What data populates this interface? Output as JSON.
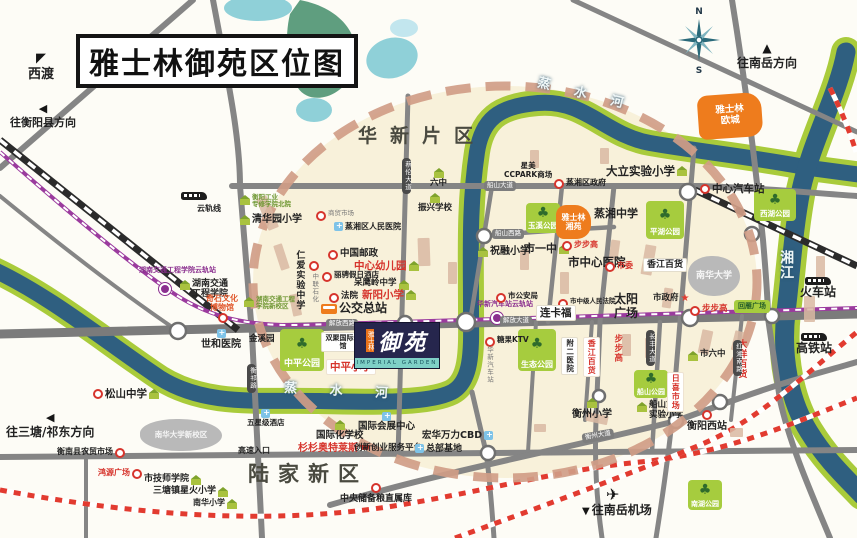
{
  "meta": {
    "title": "雅士林御苑区位图"
  },
  "compass": {
    "n": "N",
    "s": "S"
  },
  "project": {
    "brand": "雅士林",
    "name": "御苑",
    "english": "IMPERIAL GARDEN"
  },
  "colors": {
    "river": "#2f5f80",
    "river_bank": "#a9cb3b",
    "road": "#858585",
    "circle_dash": "#d09d87",
    "orange_block": "#ee7c1d",
    "park_green": "#a6cc3e",
    "rail_red": "#e23b30",
    "monorail_purple": "#9b3b9e"
  },
  "pois": [
    {
      "id": "dir-xidu",
      "cls": "dark col",
      "icon": "arrow-nw",
      "label": "西渡",
      "x": 28,
      "y": 52,
      "fs": 13
    },
    {
      "id": "dir-hengyang-county",
      "cls": "dark col",
      "icon": "arrow-l",
      "label": "往衡阳县方向",
      "x": 10,
      "y": 103,
      "fs": 11
    },
    {
      "id": "dir-nanyue",
      "cls": "dark col",
      "icon": "arrow-up",
      "label": "往南岳方向",
      "x": 737,
      "y": 42,
      "fs": 12
    },
    {
      "id": "dir-santang",
      "cls": "dark col",
      "icon": "arrow-l",
      "label": "往三塘/祁东方向",
      "x": 6,
      "y": 411,
      "fs": 12
    },
    {
      "id": "airport-plane",
      "cls": "dark",
      "icon": "plane",
      "label": "",
      "x": 606,
      "y": 487
    },
    {
      "id": "dir-airport",
      "cls": "dark",
      "icon": "arrow-dn",
      "label": "往南岳机场",
      "x": 582,
      "y": 504,
      "fs": 12
    },
    {
      "id": "river-zhengshui-top",
      "cls": "river",
      "label": "蒸 水 河",
      "x": 536,
      "y": 88,
      "fs": 13,
      "rot": 14,
      "ls": 10
    },
    {
      "id": "river-zhengshui-bottom",
      "cls": "river",
      "label": "蒸 水 河",
      "x": 284,
      "y": 385,
      "fs": 13,
      "rot": 3,
      "ls": 14
    },
    {
      "id": "river-xiangjiang",
      "cls": "river",
      "label": "湘江",
      "x": 778,
      "y": 250,
      "fs": 14,
      "vert": true,
      "ls": 8
    },
    {
      "id": "district-huaxin",
      "cls": "district",
      "label": "华新片区",
      "x": 358,
      "y": 126,
      "fs": 19,
      "ls": 13
    },
    {
      "id": "district-lujia",
      "cls": "district",
      "label": "陆家新区",
      "x": 248,
      "y": 462,
      "fs": 21,
      "ls": 9
    },
    {
      "id": "plate-jiefang-west-rd",
      "cls": "plate-h",
      "label": "解放西路",
      "x": 326,
      "y": 319,
      "fs": 6.5
    },
    {
      "id": "plate-jiefang-ave",
      "cls": "plate-h",
      "label": "解放大道",
      "x": 500,
      "y": 316,
      "fs": 6.5
    },
    {
      "id": "plate-chuanshan-ave",
      "cls": "plate-h",
      "label": "船山大道",
      "x": 484,
      "y": 181,
      "fs": 6.5
    },
    {
      "id": "plate-chuanshan-west-rd",
      "cls": "plate-h",
      "label": "船山西路",
      "x": 492,
      "y": 229,
      "fs": 6.5
    },
    {
      "id": "plate-hengzhou-ave",
      "cls": "plate-h",
      "label": "衡州大道",
      "x": 582,
      "y": 431,
      "fs": 6.5,
      "rot": -10
    },
    {
      "id": "plate-cailun-ave",
      "cls": "plate-v",
      "label": "蔡伦大道",
      "x": 402,
      "y": 158,
      "fs": 6.5
    },
    {
      "id": "plate-hengqi-rd",
      "cls": "plate-v",
      "label": "衡祁路",
      "x": 247,
      "y": 364,
      "fs": 6.5
    },
    {
      "id": "plate-changfeng-ave",
      "cls": "plate-v",
      "label": "长丰大道",
      "x": 646,
      "y": 330,
      "fs": 6.5
    },
    {
      "id": "plate-hongxiang-south-rd",
      "cls": "plate-v",
      "label": "红湘南路",
      "x": 733,
      "y": 340,
      "fs": 6.5
    },
    {
      "id": "monorail-train",
      "cls": "dark",
      "icon": "train",
      "label": "",
      "x": 181,
      "y": 192
    },
    {
      "id": "monorail-line",
      "cls": "dark",
      "label": "云轨线",
      "x": 197,
      "y": 204,
      "fs": 8
    },
    {
      "id": "station-jiaotong-dot",
      "cls": "dark",
      "icon": "station",
      "label": "",
      "x": 159,
      "y": 283
    },
    {
      "id": "station-jiaotong",
      "cls": "purple",
      "label": "湖南交通工程学院云轨站",
      "x": 139,
      "y": 266,
      "fs": 7
    },
    {
      "id": "station-huaxin-dot",
      "cls": "dark",
      "icon": "station",
      "label": "",
      "x": 491,
      "y": 312
    },
    {
      "id": "station-huaxin",
      "cls": "purple",
      "label": "华新汽车站云轨站",
      "x": 477,
      "y": 300,
      "fs": 7
    },
    {
      "id": "poi-hengyang-tech-college",
      "cls": "green",
      "icon": "school",
      "label": "衡阳工业\n专修学院北院",
      "x": 240,
      "y": 194,
      "fs": 6.5
    },
    {
      "id": "poi-qinghuayuan-primary",
      "cls": "dark",
      "icon": "school",
      "label": "清华园小学",
      "x": 240,
      "y": 214,
      "fs": 10
    },
    {
      "id": "poi-shangmao-market",
      "cls": "gray",
      "icon": "dot",
      "label": "商贸市场",
      "x": 316,
      "y": 210,
      "fs": 6.5
    },
    {
      "id": "poi-zhengxiang-people-hospital",
      "cls": "dark",
      "icon": "hosp",
      "label": "蒸湘区人民医院",
      "x": 334,
      "y": 222,
      "fs": 8
    },
    {
      "id": "poi-china-post",
      "cls": "dark",
      "icon": "dot",
      "label": "中国邮政",
      "x": 328,
      "y": 249,
      "fs": 9.5
    },
    {
      "id": "poi-central-kindergarten",
      "cls": "red",
      "icon2": "school",
      "label": "中心幼儿园",
      "x": 354,
      "y": 260,
      "fs": 10.5
    },
    {
      "id": "poi-licheng-hotel",
      "cls": "dark",
      "icon": "dot",
      "label": "丽骋假日酒店",
      "x": 322,
      "y": 271,
      "fs": 7.5
    },
    {
      "id": "poi-daiyingling-middle",
      "cls": "dark",
      "icon2": "school",
      "label": "呆鹰岭中学",
      "x": 354,
      "y": 279,
      "fs": 8.5
    },
    {
      "id": "poi-court",
      "cls": "dark",
      "icon": "dot",
      "label": "法院",
      "x": 329,
      "y": 292,
      "fs": 8.5
    },
    {
      "id": "poi-xinyang-primary",
      "cls": "red",
      "icon2": "school",
      "label": "新阳小学",
      "x": 362,
      "y": 289,
      "fs": 10.5
    },
    {
      "id": "poi-bus-terminal",
      "cls": "dark",
      "icon": "bus",
      "label": "公交总站",
      "x": 321,
      "y": 302,
      "fs": 12
    },
    {
      "id": "poi-renai-middle",
      "cls": "dark",
      "label": "仁爱实验中学",
      "x": 294,
      "y": 250,
      "fs": 9,
      "vert": true
    },
    {
      "id": "poi-zhonglian-petrol",
      "cls": "gray",
      "icon": "dot",
      "label": "中联石化",
      "x": 309,
      "y": 260,
      "fs": 6.5,
      "vert": true
    },
    {
      "id": "poi-jiaotong-new-campus",
      "cls": "green",
      "icon": "school",
      "label": "湖南交通工程\n学院新校区",
      "x": 244,
      "y": 296,
      "fs": 6.5
    },
    {
      "id": "poi-jiaotong-college",
      "cls": "dark",
      "icon": "school",
      "label": "湖南交通\n工程学院",
      "x": 180,
      "y": 279,
      "fs": 9
    },
    {
      "id": "poi-qishi-museum",
      "cls": "orangered tc",
      "label": "奇石文化\n博物馆",
      "x": 206,
      "y": 294,
      "fs": 8
    },
    {
      "id": "poi-qishi-dot",
      "cls": "dark",
      "icon": "dot",
      "label": "",
      "x": 218,
      "y": 312
    },
    {
      "id": "poi-shihe-hospital",
      "cls": "dark col",
      "icon": "hosp",
      "label": "世和医院",
      "x": 201,
      "y": 329,
      "fs": 10
    },
    {
      "id": "poi-jinxiyuan",
      "cls": "dark",
      "label": "金溪园",
      "x": 249,
      "y": 335,
      "fs": 8.5
    },
    {
      "id": "park-zhongping",
      "cls": "park",
      "label": "中平公园",
      "x": 280,
      "y": 329,
      "w": 44,
      "h": 42,
      "fs": 9
    },
    {
      "id": "poi-shuangju-mansion",
      "cls": "white-box tc",
      "label": "双聚国际公馆",
      "x": 321,
      "y": 332,
      "fs": 7,
      "w": 36
    },
    {
      "id": "poi-zhongping-primary",
      "cls": "box-red",
      "label": "中平小学",
      "x": 326,
      "y": 359,
      "fs": 10.5
    },
    {
      "id": "poi-liuzhong",
      "cls": "dark col",
      "icon": "school",
      "label": "六中",
      "x": 430,
      "y": 167,
      "fs": 8.5
    },
    {
      "id": "poi-zhenxing-school",
      "cls": "dark col",
      "icon": "school",
      "label": "振兴学校",
      "x": 418,
      "y": 192,
      "fs": 8.5
    },
    {
      "id": "poi-ccpark",
      "cls": "dark tc",
      "label": "星美\nCCPARK商场",
      "x": 504,
      "y": 162,
      "fs": 7.5
    },
    {
      "id": "poi-zhengxiang-gov",
      "cls": "dark",
      "icon": "dot",
      "label": "蒸湘区政府",
      "x": 554,
      "y": 178,
      "fs": 8
    },
    {
      "id": "poi-dali-primary",
      "cls": "dark",
      "icon2": "school",
      "label": "大立实验小学",
      "x": 606,
      "y": 165,
      "fs": 11.5
    },
    {
      "id": "poi-central-bus-station",
      "cls": "dark",
      "icon": "dot",
      "label": "中心汽车站",
      "x": 700,
      "y": 183,
      "fs": 10.5
    },
    {
      "id": "park-xihu",
      "cls": "park",
      "label": "西湖公园",
      "x": 754,
      "y": 189,
      "w": 42,
      "h": 32,
      "fs": 7.5
    },
    {
      "id": "park-yuxi",
      "cls": "park",
      "label": "玉溪公园",
      "x": 526,
      "y": 203,
      "w": 34,
      "h": 30,
      "fs": 7.5
    },
    {
      "id": "block-yashilin-xiangyuan",
      "cls": "orange",
      "label": "雅士林\n湘苑",
      "x": 556,
      "y": 205,
      "w": 35,
      "h": 34,
      "fs": 8
    },
    {
      "id": "poi-zhengxiang-middle",
      "cls": "dark",
      "label": "蒸湘中学",
      "x": 594,
      "y": 208,
      "fs": 11
    },
    {
      "id": "park-pinghu",
      "cls": "park",
      "label": "平湖公园",
      "x": 646,
      "y": 201,
      "w": 38,
      "h": 38,
      "fs": 7.5
    },
    {
      "id": "block-yashilin-oucheng",
      "cls": "orange",
      "label": "雅士林\n欧城",
      "x": 698,
      "y": 94,
      "w": 64,
      "h": 44,
      "fs": 9.5,
      "rot": -4
    },
    {
      "id": "poi-zhurong-primary",
      "cls": "dark",
      "icon": "school",
      "label": "祝融小学",
      "x": 478,
      "y": 246,
      "fs": 10
    },
    {
      "id": "poi-shiyizhong",
      "cls": "dark",
      "icon2": "school",
      "label": "市一中",
      "x": 524,
      "y": 243,
      "fs": 11
    },
    {
      "id": "poi-bubugao-2",
      "cls": "red",
      "icon": "dot",
      "label": "步步高",
      "x": 562,
      "y": 240,
      "fs": 8
    },
    {
      "id": "poi-city-central-hospital",
      "cls": "dark",
      "label": "市中心医院",
      "x": 568,
      "y": 256,
      "fs": 11.5
    },
    {
      "id": "poi-shiwei",
      "cls": "red",
      "icon": "dot",
      "label": "市委",
      "x": 605,
      "y": 261,
      "fs": 8
    },
    {
      "id": "poi-xiangjiang-dept",
      "cls": "white-box",
      "label": "香江百货",
      "x": 643,
      "y": 258,
      "fs": 9
    },
    {
      "id": "blob-nanhua-univ",
      "cls": "blob-gray",
      "label": "南华大学",
      "x": 688,
      "y": 256,
      "w": 52,
      "h": 40,
      "fs": 9
    },
    {
      "id": "poi-public-security",
      "cls": "dark",
      "icon": "dot",
      "label": "市公安局",
      "x": 496,
      "y": 292,
      "fs": 7.5
    },
    {
      "id": "poi-intermediate-court",
      "cls": "dark",
      "icon": "dot",
      "label": "市中级人民法院",
      "x": 558,
      "y": 298,
      "fs": 6.5
    },
    {
      "id": "poi-lianka",
      "cls": "white-box",
      "label": "连卡福",
      "x": 536,
      "y": 305,
      "fs": 10.5
    },
    {
      "id": "poi-taiyang-square",
      "cls": "dark tc",
      "label": "太阳\n广场",
      "x": 614,
      "y": 293,
      "fs": 12
    },
    {
      "id": "poi-city-gov",
      "cls": "dark",
      "icon2": "star",
      "label": "市政府",
      "x": 653,
      "y": 294,
      "fs": 8.5
    },
    {
      "id": "poi-bubugao-dot",
      "cls": "red",
      "icon": "dot",
      "label": "步步高",
      "x": 690,
      "y": 305,
      "fs": 8.5
    },
    {
      "id": "park-huiyan-square",
      "cls": "park-flat",
      "label": "回雁广场",
      "x": 734,
      "y": 300,
      "w": 36,
      "h": 13,
      "fs": 7
    },
    {
      "id": "poi-tangguo-ktv",
      "cls": "dark",
      "icon": "dot",
      "label": "糖果KTV",
      "x": 485,
      "y": 336,
      "fs": 7.5
    },
    {
      "id": "poi-huaxin-bus-station",
      "cls": "gray",
      "label": "华新汽车站",
      "x": 485,
      "y": 346,
      "fs": 6.5,
      "vert": true
    },
    {
      "id": "park-shengtai",
      "cls": "park",
      "label": "生态公园",
      "x": 518,
      "y": 329,
      "w": 38,
      "h": 42,
      "fs": 8
    },
    {
      "id": "poi-fuer-hospital",
      "cls": "white-box",
      "label": "附二医院",
      "x": 561,
      "y": 337,
      "fs": 7.5,
      "vert": true
    },
    {
      "id": "poi-xiangjiang-dept-v",
      "cls": "box-red",
      "label": "香江百货",
      "x": 583,
      "y": 337,
      "fs": 8,
      "vert": true
    },
    {
      "id": "poi-bubugao-v",
      "cls": "red",
      "label": "步步高",
      "x": 612,
      "y": 334,
      "fs": 8.5,
      "vert": true
    },
    {
      "id": "poi-dayang-dept",
      "cls": "red",
      "label": "大洋百货",
      "x": 736,
      "y": 339,
      "fs": 9,
      "vert": true
    },
    {
      "id": "poi-shiliuzhong",
      "cls": "dark",
      "icon": "school",
      "label": "市六中",
      "x": 688,
      "y": 350,
      "fs": 8.5
    },
    {
      "id": "poi-railway-station",
      "cls": "dark col",
      "icon": "train",
      "label": "火车站",
      "x": 800,
      "y": 277,
      "fs": 12
    },
    {
      "id": "poi-hsr-station",
      "cls": "dark col",
      "icon": "train",
      "label": "高铁站",
      "x": 796,
      "y": 333,
      "fs": 12
    },
    {
      "id": "poi-hengzhou-primary",
      "cls": "dark col",
      "icon": "school",
      "label": "衡州小学",
      "x": 572,
      "y": 397,
      "fs": 10
    },
    {
      "id": "park-chuanshan",
      "cls": "park",
      "label": "船山公园",
      "x": 634,
      "y": 370,
      "w": 34,
      "h": 28,
      "fs": 7
    },
    {
      "id": "poi-chuanshan-2nd-primary",
      "cls": "dark",
      "icon": "school",
      "label": "船山第二\n实验小学",
      "x": 637,
      "y": 401,
      "fs": 8.5
    },
    {
      "id": "poi-rixi-market",
      "cls": "box-red",
      "label": "日喜市场",
      "x": 667,
      "y": 372,
      "fs": 8,
      "vert": true
    },
    {
      "id": "poi-hengyang-west-station",
      "cls": "dark col",
      "icon": "dot",
      "label": "衡阳西站",
      "x": 687,
      "y": 409,
      "fs": 10
    },
    {
      "id": "park-nanhu",
      "cls": "park",
      "label": "南湖公园",
      "x": 688,
      "y": 480,
      "w": 34,
      "h": 30,
      "fs": 7
    },
    {
      "id": "poi-songshan-middle",
      "cls": "dark",
      "icon": "dot",
      "icon2": "school",
      "label": "松山中学",
      "x": 93,
      "y": 388,
      "fs": 10.5
    },
    {
      "id": "blob-nanhua-new-campus",
      "cls": "blob-gray",
      "label": "南华大学新校区",
      "x": 140,
      "y": 419,
      "w": 82,
      "h": 32,
      "fs": 7.5
    },
    {
      "id": "poi-hengnan-market",
      "cls": "dark",
      "icon2": "dot",
      "label": "衡南县农贸市场",
      "x": 57,
      "y": 447,
      "fs": 8
    },
    {
      "id": "poi-hongyuan-square",
      "cls": "red",
      "icon2": "dot",
      "label": "鸿源广场",
      "x": 98,
      "y": 468,
      "fs": 8
    },
    {
      "id": "poi-tech-teachers-college",
      "cls": "dark",
      "icon2": "school",
      "label": "市技师学院",
      "x": 144,
      "y": 474,
      "fs": 9
    },
    {
      "id": "poi-santang-xinghuo-primary",
      "cls": "dark",
      "icon2": "school",
      "label": "三塘镇星火小学",
      "x": 153,
      "y": 486,
      "fs": 9
    },
    {
      "id": "poi-nanhua-primary",
      "cls": "dark",
      "icon2": "school",
      "label": "南华小学",
      "x": 193,
      "y": 498,
      "fs": 8
    },
    {
      "id": "poi-five-star-hotel",
      "cls": "dark col",
      "icon": "hosp",
      "label": "五星级酒店",
      "x": 247,
      "y": 409,
      "fs": 7.5
    },
    {
      "id": "poi-highway-entrance",
      "cls": "dark",
      "label": "高速入口",
      "x": 238,
      "y": 446,
      "fs": 8
    },
    {
      "id": "poi-intl-school",
      "cls": "dark col",
      "icon": "school",
      "label": "国际化学校",
      "x": 316,
      "y": 419,
      "fs": 9.5
    },
    {
      "id": "poi-intl-expo-center",
      "cls": "dark col",
      "icon": "hosp",
      "label": "国际会展中心",
      "x": 358,
      "y": 412,
      "fs": 9.5
    },
    {
      "id": "poi-shanshan-outlets",
      "cls": "red",
      "icon2": "cart",
      "label": "杉杉奥特莱斯",
      "x": 298,
      "y": 443,
      "fs": 10
    },
    {
      "id": "poi-innovation-platform",
      "cls": "dark",
      "label": "创新创业服务平台",
      "x": 354,
      "y": 444,
      "fs": 8.5
    },
    {
      "id": "poi-honghua-cbd",
      "cls": "dark",
      "icon2": "hosp",
      "label": "宏华万力CBD",
      "x": 422,
      "y": 431,
      "fs": 9.5
    },
    {
      "id": "poi-hq-base",
      "cls": "dark",
      "icon": "hosp",
      "label": "总部基地",
      "x": 415,
      "y": 444,
      "fs": 9
    },
    {
      "id": "poi-grain-depot",
      "cls": "dark col",
      "icon": "dot",
      "label": "中央储备粮直属库",
      "x": 340,
      "y": 482,
      "fs": 9
    }
  ],
  "buildings": [
    [
      262,
      196,
      11,
      34,
      -22
    ],
    [
      277,
      244,
      9,
      26,
      -18
    ],
    [
      291,
      294,
      9,
      22,
      -12
    ],
    [
      418,
      238,
      12,
      28,
      -2
    ],
    [
      448,
      262,
      9,
      22,
      0
    ],
    [
      520,
      250,
      9,
      20,
      0
    ],
    [
      560,
      272,
      9,
      22,
      0
    ],
    [
      610,
      240,
      9,
      20,
      8
    ],
    [
      643,
      245,
      11,
      30,
      10
    ],
    [
      663,
      288,
      9,
      20,
      8
    ],
    [
      622,
      334,
      9,
      22,
      0
    ],
    [
      645,
      338,
      9,
      20,
      0
    ],
    [
      700,
      330,
      11,
      24,
      12
    ],
    [
      733,
      331,
      9,
      20,
      14
    ],
    [
      804,
      296,
      11,
      26,
      0
    ],
    [
      816,
      256,
      9,
      22,
      0
    ],
    [
      586,
      414,
      22,
      9,
      12
    ],
    [
      534,
      424,
      12,
      8,
      0
    ],
    [
      730,
      428,
      13,
      9,
      0
    ],
    [
      530,
      150,
      9,
      18,
      0
    ],
    [
      600,
      148,
      9,
      16,
      0
    ]
  ]
}
